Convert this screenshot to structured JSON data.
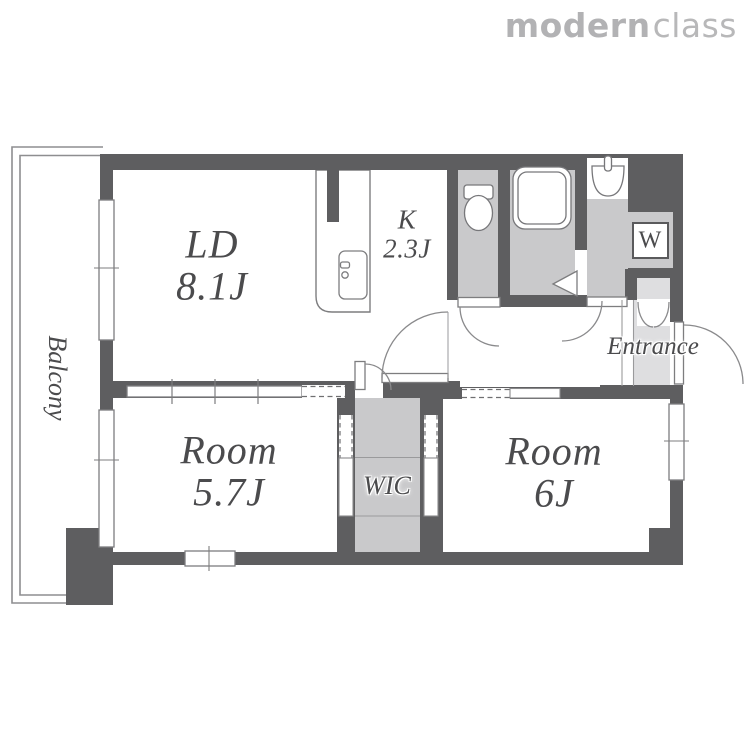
{
  "logo": {
    "bold": "modern",
    "light": "class"
  },
  "floorplan": {
    "living_dining": {
      "name": "LD",
      "size": "8.1J"
    },
    "kitchen": {
      "name": "K",
      "size": "2.3J"
    },
    "room_57": {
      "name": "Room",
      "size": "5.7J"
    },
    "room_6": {
      "name": "Room",
      "size": "6J"
    },
    "wic": {
      "label": "WIC"
    },
    "entrance": {
      "label": "Entrance"
    },
    "balcony": {
      "label": "Balcony"
    },
    "washer": {
      "label": "W"
    }
  },
  "colors": {
    "wall": "#5e5e60",
    "wet_floor": "#c9c9cb",
    "entry_floor": "#dedee0",
    "line": "#7d7d7f",
    "text": "#4b4b4d",
    "logo": "#b2b2b4"
  }
}
